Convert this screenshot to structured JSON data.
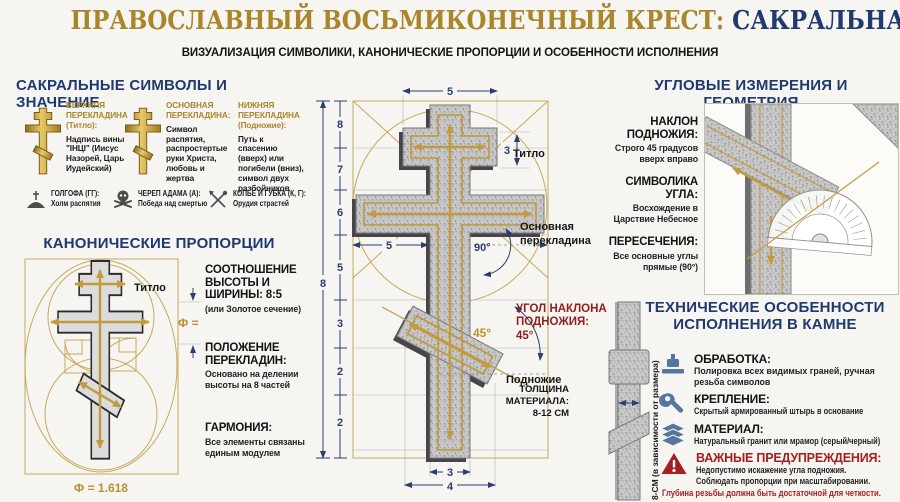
{
  "colors": {
    "navy": "#1e3a6e",
    "gold": "#a8862c",
    "red": "#a32020",
    "dark_red": "#8e1f1f",
    "granite": "#c9c9c9",
    "steel_blue": "#55769e"
  },
  "header": {
    "title_gold": "ПРАВОСЛАВНЫЙ ВОСЬМИКОНЕЧНЫЙ КРЕСТ: ",
    "title_navy": "САКРАЛЬНАЯ ГЕОМЕТРИЯ",
    "subtitle": "ВИЗУАЛИЗАЦИЯ СИМВОЛИКИ, КАНОНИЧЕСКИЕ ПРОПОРЦИИ И ОСОБЕННОСТИ ИСПОЛНЕНИЯ"
  },
  "symbols": {
    "title": "САКРАЛЬНЫЕ СИМВОЛЫ И ЗНАЧЕНИЕ",
    "col1_label": "ВЕРХНЯЯ ПЕРЕКЛАДИНА (Титло):",
    "col1_text": "Надпись вины \"ІНЦІ\" (Иисус Назорей, Царь Иудейский)",
    "col2_label": "ОСНОВНАЯ ПЕРЕКЛАДИНА:",
    "col2_text": "Символ распятия, распростертые руки Христа, любовь и жертва",
    "col3_label": "НИЖНЯЯ ПЕРЕКЛАДИНА (Подножие):",
    "col3_text": "Путь к спасению (вверх) или погибели (вниз), символ двух разбойников",
    "glossary": [
      {
        "term": "ГОЛГОФА (ГГ):",
        "desc": "Холм распятия"
      },
      {
        "term": "ЧЕРЕП АДАМА (А):",
        "desc": "Победа над смертью"
      },
      {
        "term": "КОПЬЕ И ГУБКА (К, Г):",
        "desc": "Орудия страстей"
      }
    ]
  },
  "proportions": {
    "title": "КАНОНИЧЕСКИЕ ПРОПОРЦИИ",
    "titlo_label": "Титло",
    "phi_label": "Ф =",
    "phi_value": "Ф = 1.618",
    "item1_title": "СООТНОШЕНИЕ ВЫСОТЫ И ШИРИНЫ: 8:5",
    "item1_note": "(или Золотое сечение)",
    "item2_title": "ПОЛОЖЕНИЕ ПЕРЕКЛАДИН:",
    "item2_note": "Основано на делении высоты на 8 частей",
    "item3_title": "ГАРМОНИЯ:",
    "item3_note": "Все элементы связаны единым модулем"
  },
  "blueprint": {
    "total_height": "8",
    "segments": [
      "8",
      "7",
      "6",
      "5",
      "3",
      "2",
      "2"
    ],
    "top_width": "5",
    "titlo_height": "3",
    "half_width": "5",
    "right_angle": "90°",
    "foot_angle_gold": "45°",
    "bottom_post": "3",
    "bottom_foot": "4",
    "titlo_label": "Титло",
    "main_label_line1": "Основная",
    "main_label_line2": "перекладина",
    "foot_label": "Подножие",
    "callout_line1": "УГОЛ НАКЛОНА",
    "callout_line2": "ПОДНОЖИЯ:",
    "callout_line3": "45°"
  },
  "geometry": {
    "title": "УГЛОВЫЕ ИЗМЕРЕНИЯ И ГЕОМЕТРИЯ",
    "item1_title": "НАКЛОН ПОДНОЖИЯ:",
    "item1_note": "Строго 45 градусов вверх вправо",
    "item2_title": "СИМВОЛИКА УГЛА:",
    "item2_note": "Восхождение в Царствие Небесное",
    "item3_title": "ПЕРЕСЕЧЕНИЯ:",
    "item3_note": "Все основные углы прямые (90°)"
  },
  "technical": {
    "title_line1": "ТЕХНИЧЕСКИЕ ОСОБЕННОСТИ",
    "title_line2": "ИСПОЛНЕНИЯ В КАМНЕ",
    "thickness_label": "ТОЛЩИНА МАТЕРИАЛА: 8-12 СМ",
    "thickness_note": "8-СМ (в зависимости от размера)",
    "item1_title": "ОБРАБОТКА:",
    "item1_note": "Полировка всех видимых граней, ручная резьба символов",
    "item2_title": "КРЕПЛЕНИЕ:",
    "item2_note": "Скрытый армированный штырь в основание",
    "item3_title": "МАТЕРИАЛ:",
    "item3_note": "Натуральный гранит или мрамор (серый/черный)",
    "warn_title": "ВАЖНЫЕ ПРЕДУПРЕЖДЕНИЯ:",
    "warn_line1": "Недопустимо искажение угла подножия.",
    "warn_line2": "Соблюдать пропорции при масштабировании.",
    "warn_line3": "Глубина резьбы должна быть достаточной для четкости."
  }
}
